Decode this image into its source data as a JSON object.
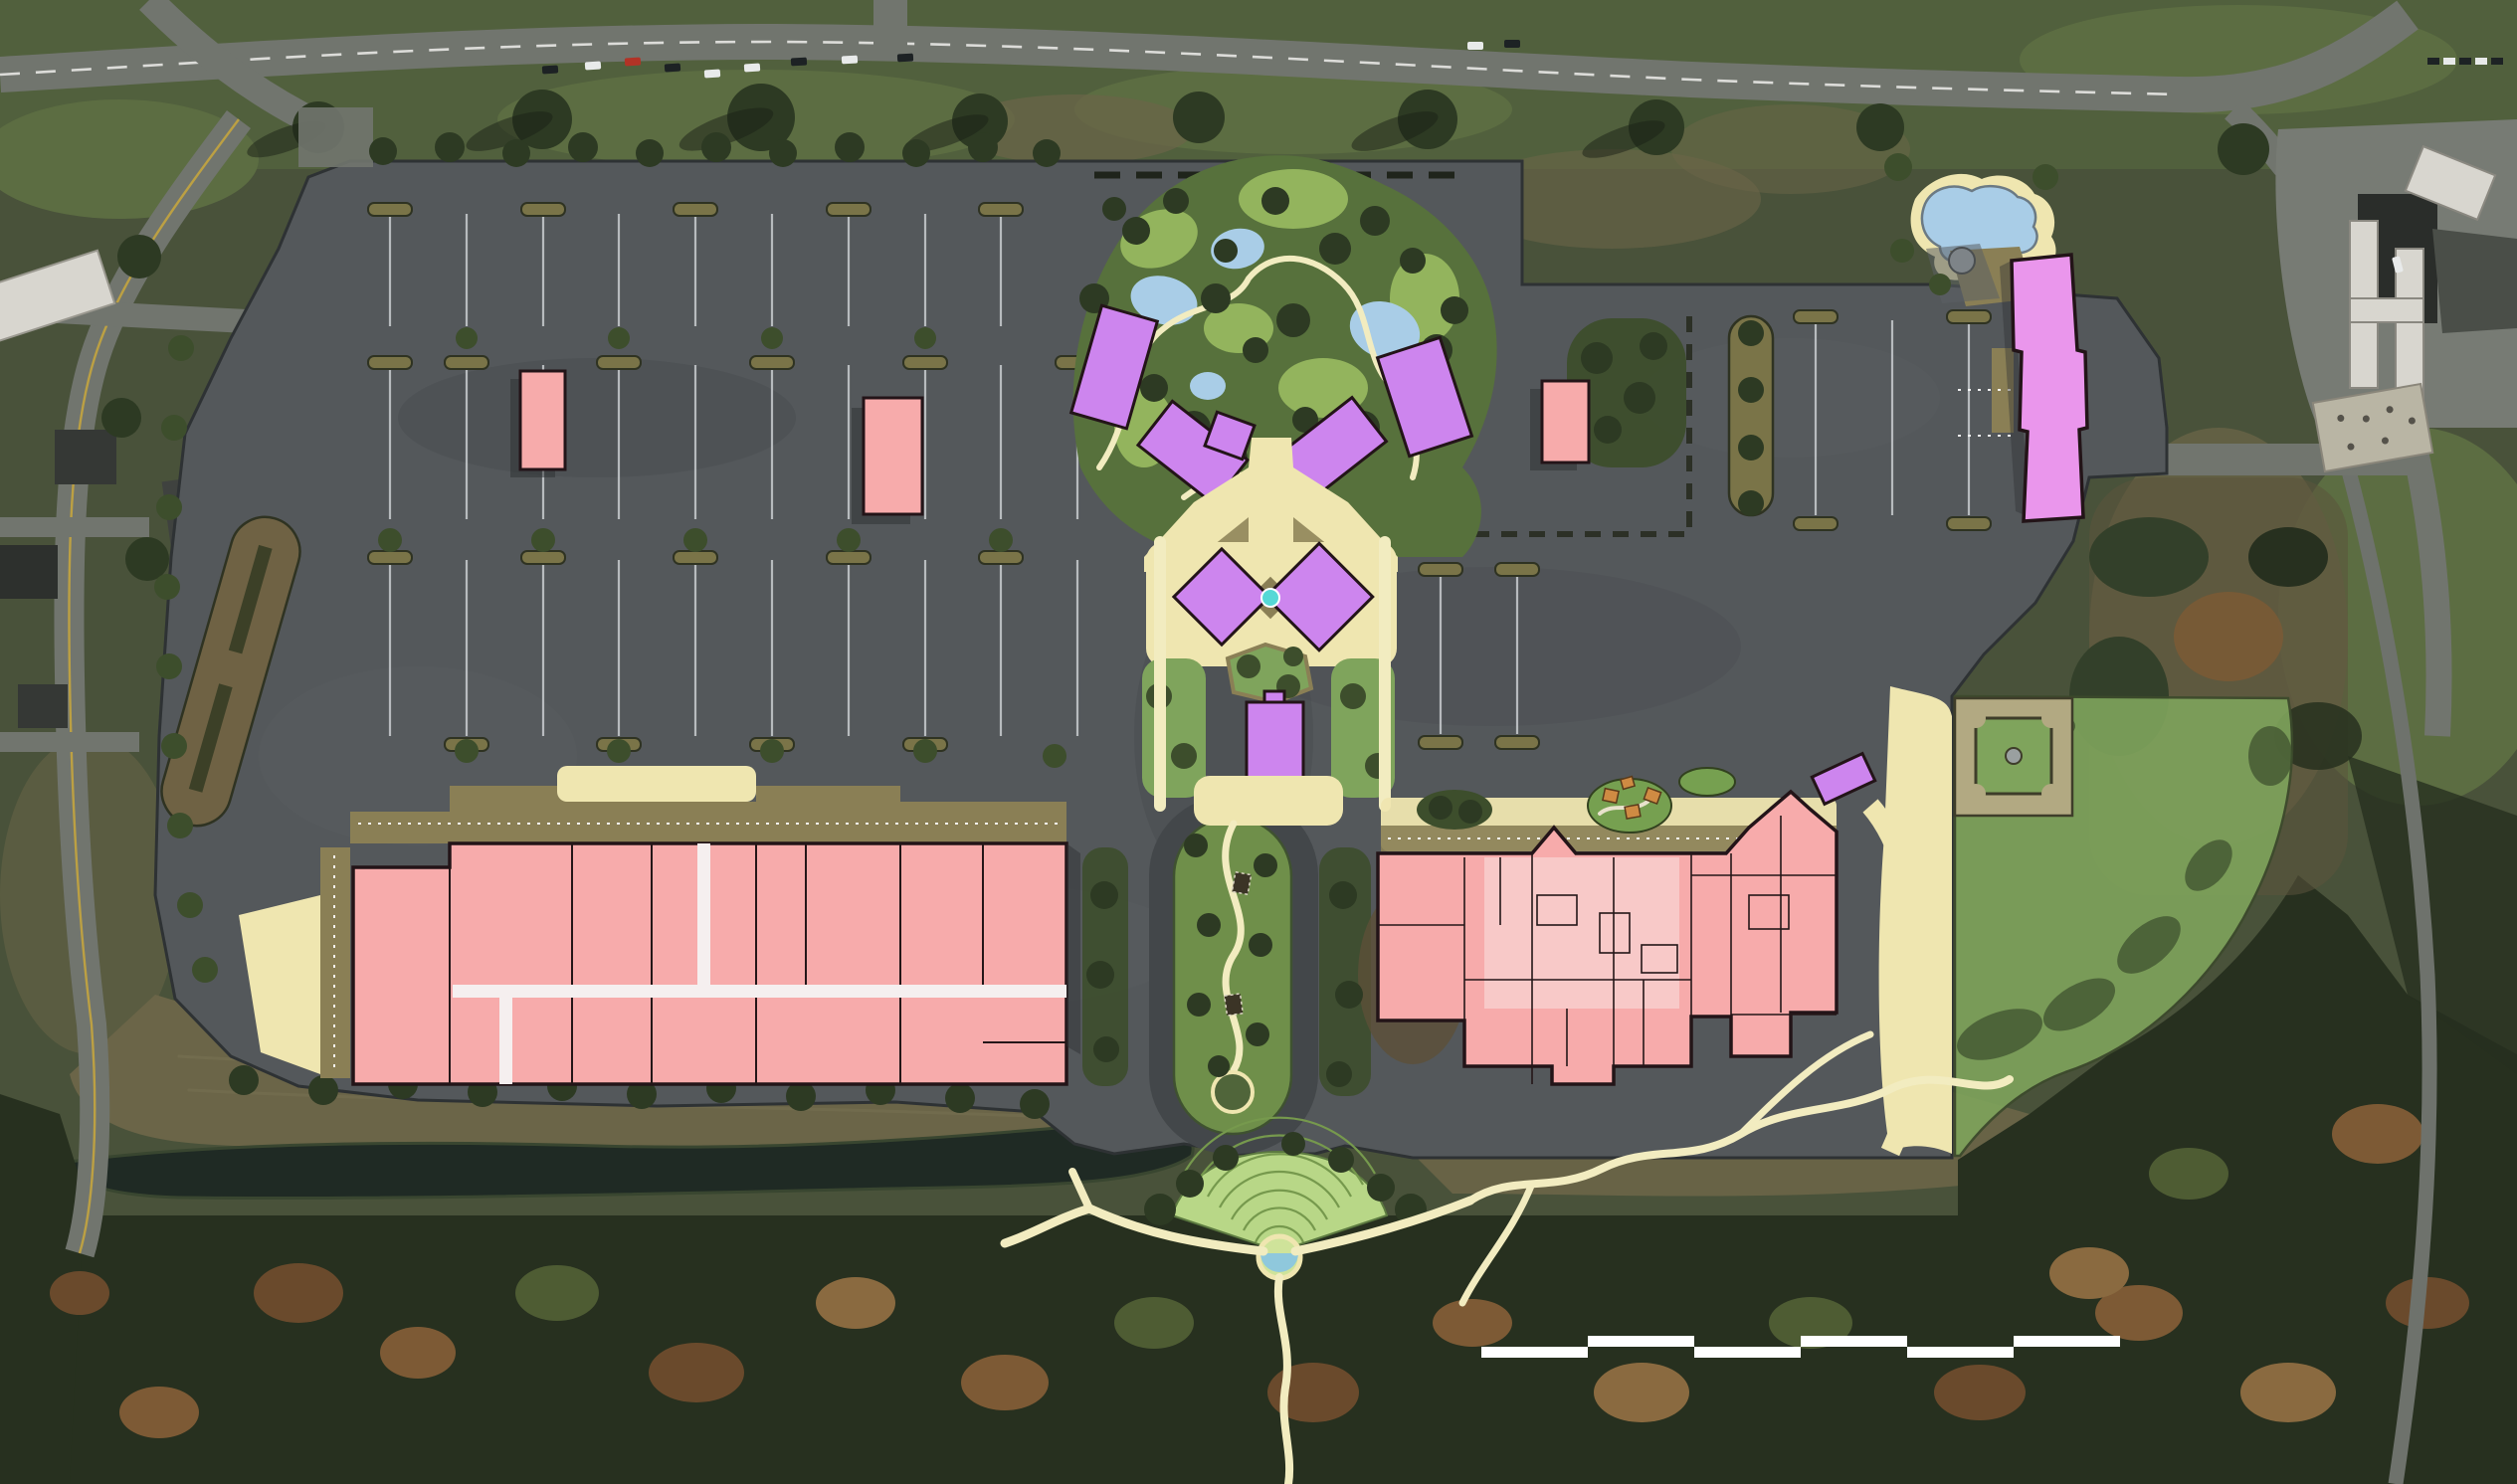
{
  "scene": {
    "kind": "aerial-site-masterplan",
    "labels": {
      "site": "shopping-center-redevelopment-plan",
      "main_parking_lot": "main-parking-lot",
      "left_retail_building": "large-pink-retail-building",
      "right_building_complex": "pink-building-complex",
      "garden_cluster": "cottage-garden-cluster",
      "village_green": "village-green-with-fountain",
      "central_spine": "landscaped-central-spine",
      "amphitheater": "fan-lawn-amphitheater",
      "pool": "swimming-pool",
      "great_lawn": "great-lawn-with-parterre-garden",
      "pond": "pond-and-stream",
      "scale_bar": "alternating-scale-bar"
    }
  },
  "colors": {
    "base_ground": "#49523a",
    "grass_top": "#51603d",
    "grass_bright": "#5c6d42",
    "field_brown": "#6b6548",
    "woods_dark": "#27301f",
    "woods_mid": "#33402a",
    "autumn1": "#6a4a2c",
    "autumn2": "#7d5a35",
    "autumn3": "#8a6a40",
    "autumn4": "#4e5c33",
    "pond": "#1f2a24",
    "pond_edge": "#394630",
    "road_gray": "#71756e",
    "road_narrow": "#6e726c",
    "asphalt": "#54585b",
    "asphalt_dark": "#43474a",
    "asphalt_light": "#686c6f",
    "curb": "#2e3234",
    "stall_line": "#c9ccd0",
    "island_olive": "#7a7448",
    "island_brown": "#6f6244",
    "hedge_dark": "#3c4027",
    "tree_dark": "#2d3a23",
    "tree_mid": "#3d4e2c",
    "lawn_mid": "#7fa45c",
    "lawn_pale": "#b8d787",
    "arc_green": "#76994d",
    "garden_base": "#57713c",
    "garden_lawn": "#93b45d",
    "path_cream": "#f2ecc0",
    "walk_tan": "#8a7f55",
    "plaza_cream": "#efe6b0",
    "water_blue": "#a9cde7",
    "water_cyan": "#56d8d6",
    "bldg_pink": "#f7abab",
    "bldg_pink_light": "#f8c9c8",
    "bldg_outline": "#231418",
    "bldg_purple": "#cd85ee",
    "bldg_purple_light": "#ea96ec",
    "shadow": "#2c2f31",
    "roof_white": "#d8d6cf",
    "concrete": "#b9b5a4",
    "offsite_roof_dark": "#353835",
    "car_red": "#b23326",
    "car_dark": "#1d2224",
    "car_white": "#e8eaea",
    "line_yellow": "#c9a83c",
    "line_white": "#e8e8e4",
    "play_orange": "#cf8b43",
    "boundary_dash": "#2c3026",
    "hedge_row_dash": "#1f241b",
    "mulch_brown": "#5c5038",
    "parterre_tan": "#b2a982",
    "fountain_gray": "#9aa0a0",
    "scale_white": "#ffffff"
  },
  "scale_bar": {
    "segments": 6,
    "rows": "alternating-offset",
    "segment_color": "#ffffff"
  }
}
